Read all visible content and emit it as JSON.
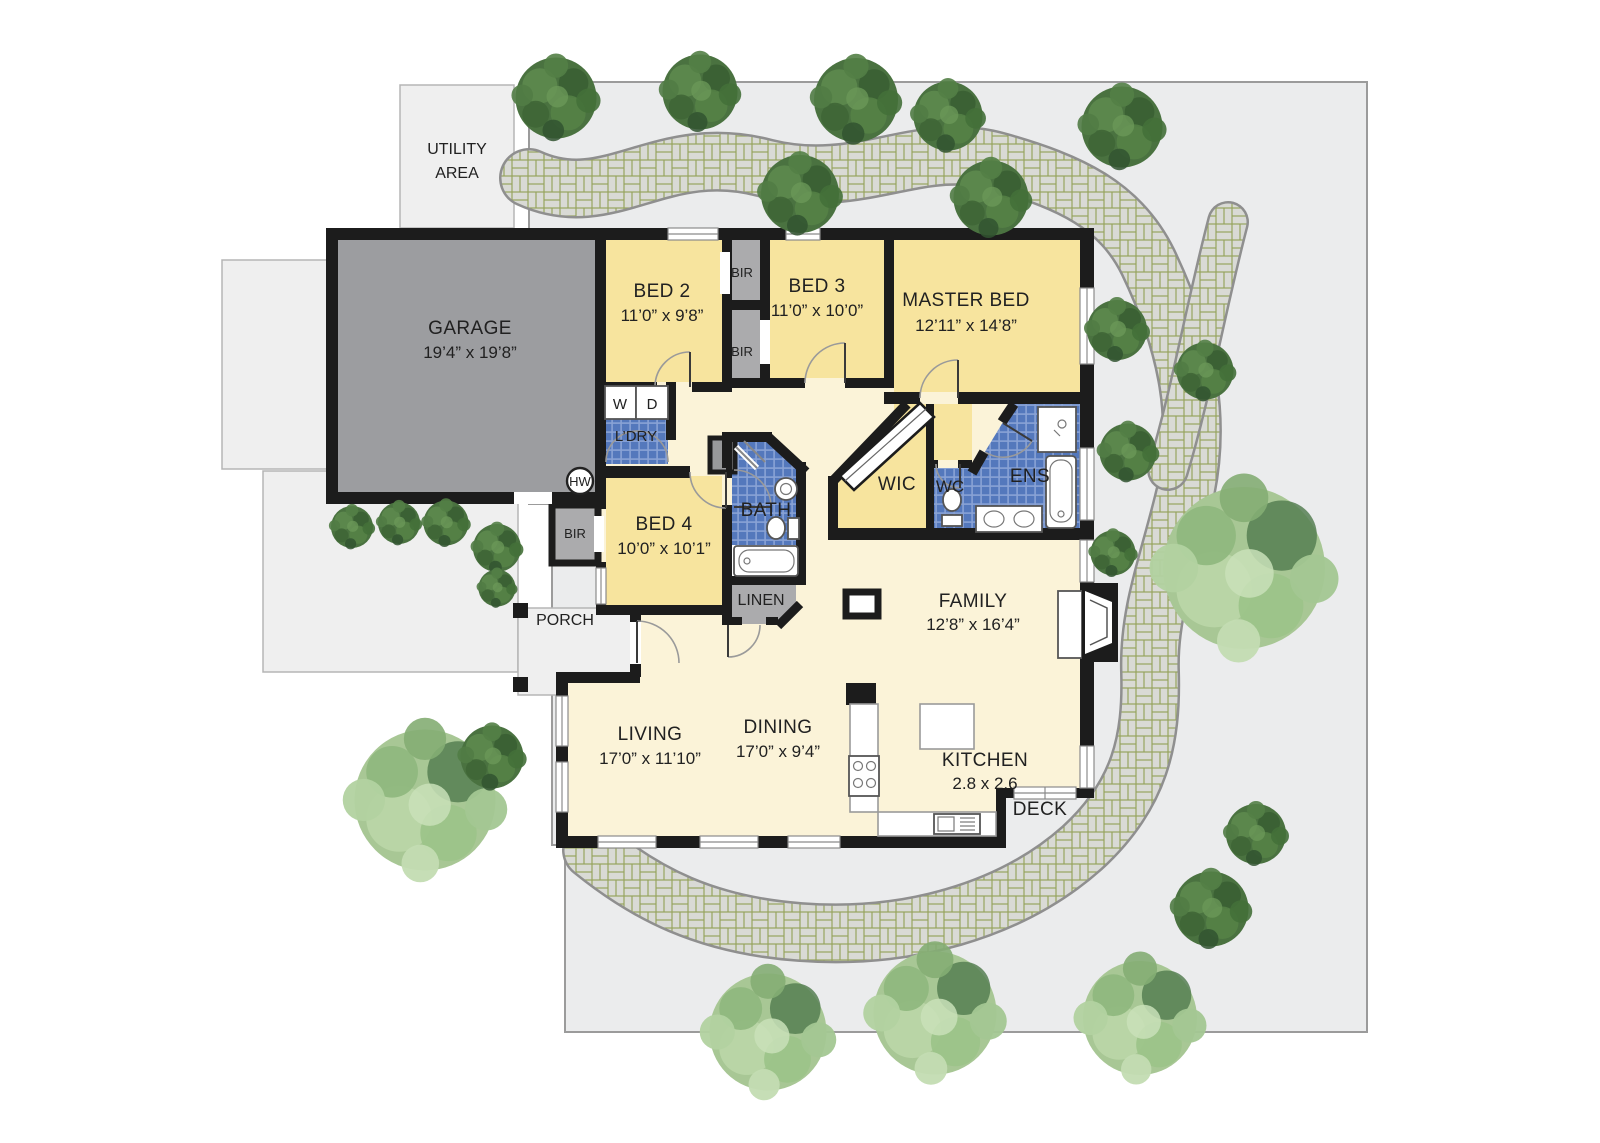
{
  "colors": {
    "wall": "#1c1c1c",
    "room_yellow": "#f7e49e",
    "floor_cream": "#fbf3d8",
    "garage_gray": "#9c9da0",
    "closet_gray": "#ababad",
    "nook_gray": "#98999b",
    "tile_blue": "#5478bc",
    "tile_grout": "#89a2d5",
    "yard_gray": "#ebeced",
    "paving_gray": "#efefef",
    "brick_gray": "#d9dad5",
    "brick_grout": "#96a45e",
    "tree_dark": "#4a7240",
    "tree_light": "#a8c795",
    "text": "#212121"
  },
  "site": {
    "utility_line1": "UTILITY",
    "utility_line2": "AREA",
    "porch_label": "PORCH",
    "deck_label": "DECK"
  },
  "rooms": [
    {
      "id": "garage",
      "label": "GARAGE",
      "dims": "19’4” x 19’8”"
    },
    {
      "id": "bed2",
      "label": "BED 2",
      "dims": "11’0” x 9’8”"
    },
    {
      "id": "bed3",
      "label": "BED 3",
      "dims": "11’0” x 10’0”"
    },
    {
      "id": "master",
      "label": "MASTER BED",
      "dims": "12’11” x 14’8”"
    },
    {
      "id": "bed4",
      "label": "BED 4",
      "dims": "10’0” x 10’1”"
    },
    {
      "id": "family",
      "label": "FAMILY",
      "dims": "12’8” x 16’4”"
    },
    {
      "id": "living",
      "label": "LIVING",
      "dims": "17’0” x 11’10”"
    },
    {
      "id": "dining",
      "label": "DINING",
      "dims": "17’0” x 9’4”"
    },
    {
      "id": "kitchen",
      "label": "KITCHEN",
      "dims": "2.8 x 2.6"
    }
  ],
  "closets": {
    "bir": "BIR",
    "wic": "WIC",
    "linen": "LINEN"
  },
  "wet": {
    "laundry": "L’DRY",
    "washer": "W",
    "dryer": "D",
    "hot_water": "HW",
    "bath": "BATH",
    "wc": "WC",
    "ensuite": "ENS"
  }
}
